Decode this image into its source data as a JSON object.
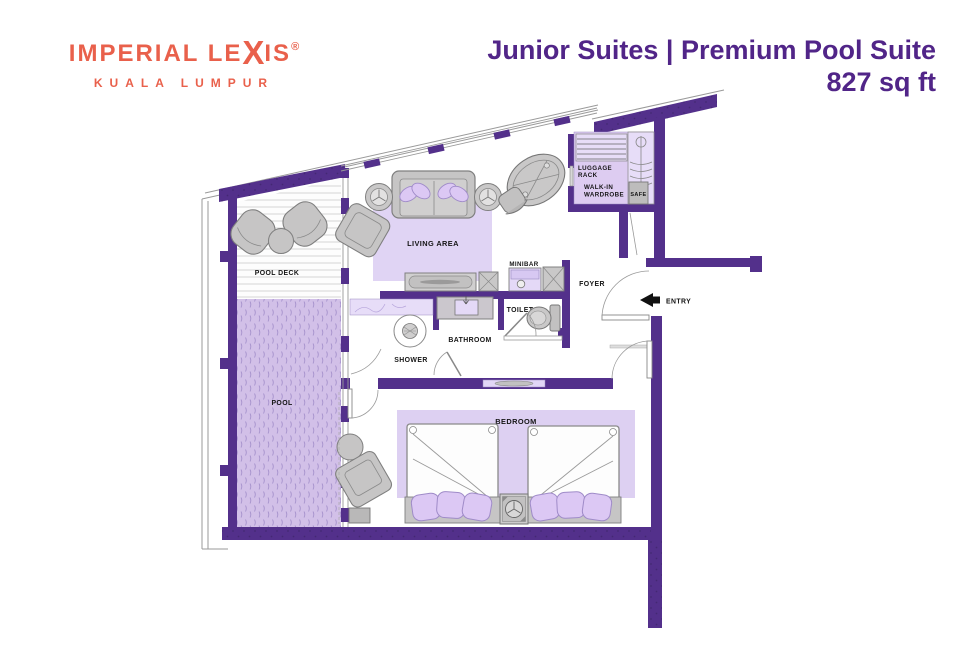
{
  "header": {
    "logo": {
      "brand_pre": "IMPERIAL LE",
      "brand_x": "X",
      "brand_post": "IS",
      "registered": "®",
      "city": "KUALA LUMPUR"
    },
    "title": {
      "line1": "Junior Suites | Premium Pool Suite",
      "line2": "827 sq ft"
    }
  },
  "floorplan": {
    "labels": {
      "pool_deck": "POOL DECK",
      "pool": "POOL",
      "living_area": "LIVING AREA",
      "minibar": "MINIBAR",
      "shower": "SHOWER",
      "bathroom": "BATHROOM",
      "toilet": "TOILET",
      "foyer": "FOYER",
      "entry": "ENTRY",
      "bedroom": "BEDROOM",
      "luggage_line1": "LUGGAGE",
      "luggage_line2": "RACK",
      "wardrobe_line1": "WALK-IN",
      "wardrobe_line2": "WARDROBE",
      "safe": "SAFE"
    },
    "colors": {
      "wall_purple": "#53308B",
      "interior_light_purple": "#DDCCF1",
      "pool_fill": "#D2C0E8",
      "rug_fill": "#DDD0F2",
      "furniture_gray": "#C6C5C5",
      "title_purple": "#512588",
      "brand_coral": "#E9604B",
      "entry_arrow": "#111111"
    }
  }
}
